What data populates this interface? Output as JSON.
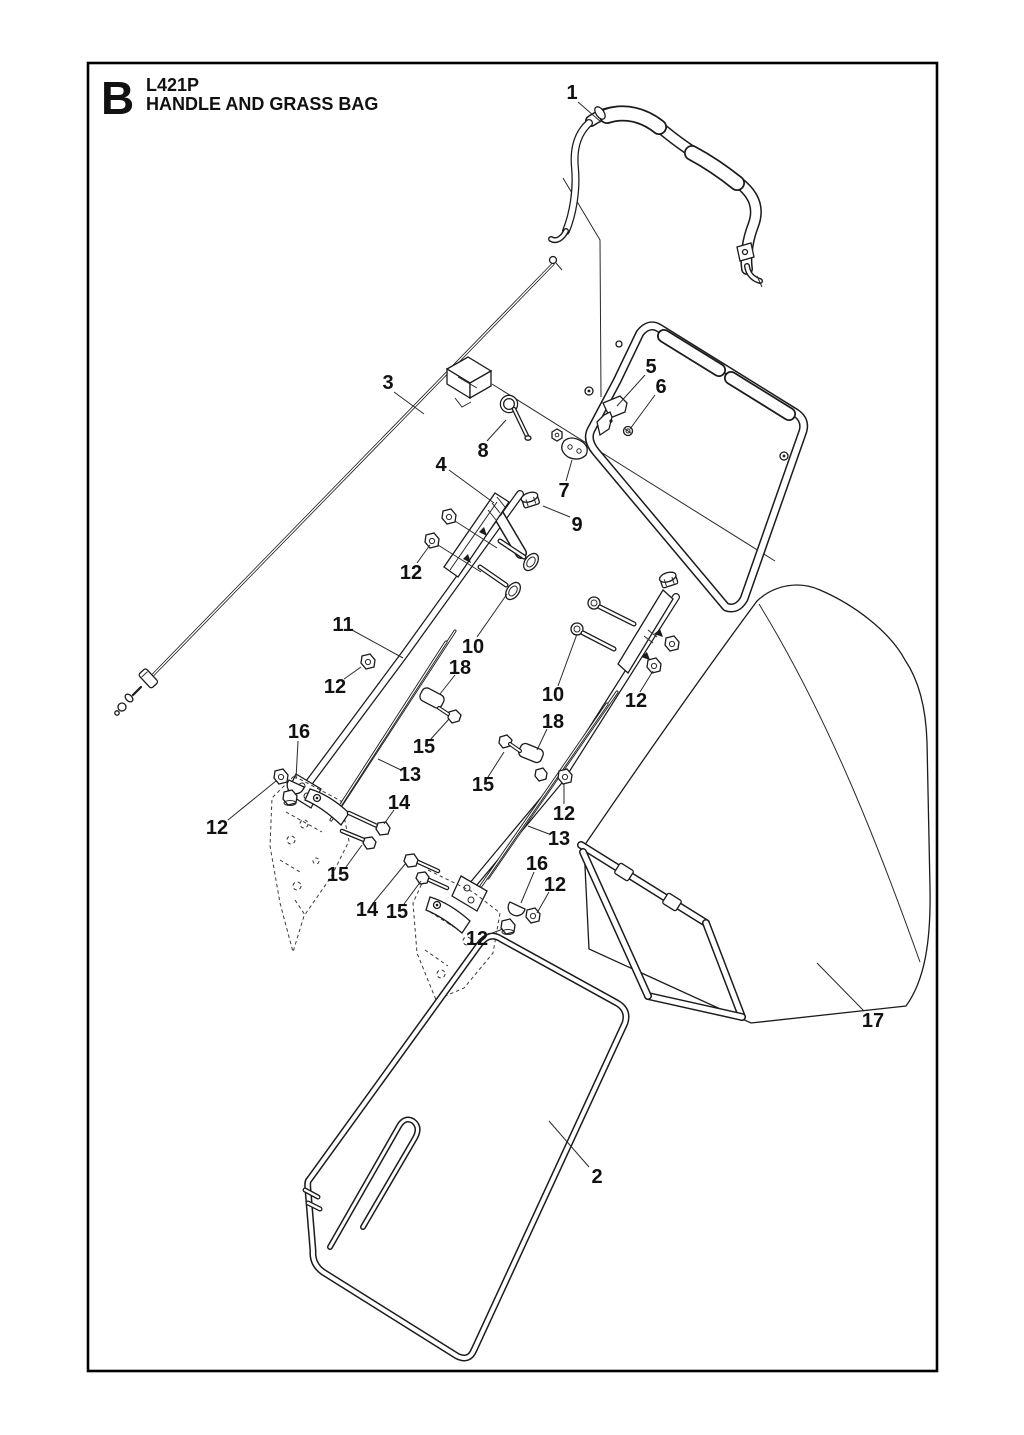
{
  "title_block": {
    "section_letter": "B",
    "model": "L421P",
    "subtitle": "HANDLE AND GRASS BAG"
  },
  "colors": {
    "line": "#1b1b1b",
    "background": "#ffffff"
  },
  "diagram": {
    "description": "Exploded parts view of lawn mower handle and grass bag assembly",
    "part_numbers_visible": [
      1,
      2,
      3,
      4,
      5,
      6,
      7,
      8,
      9,
      10,
      11,
      12,
      13,
      14,
      15,
      16,
      17,
      18
    ],
    "callouts": [
      {
        "label": "1",
        "x": 572,
        "y": 92,
        "leader": [
          578,
          102,
          601,
          122
        ]
      },
      {
        "label": "3",
        "x": 388,
        "y": 382,
        "leader": [
          394,
          392,
          424,
          414
        ]
      },
      {
        "label": "5",
        "x": 651,
        "y": 366,
        "leader": [
          645,
          375,
          617,
          406
        ]
      },
      {
        "label": "6",
        "x": 661,
        "y": 386,
        "leader": [
          655,
          395,
          630,
          429
        ]
      },
      {
        "label": "8",
        "x": 483,
        "y": 450,
        "leader": [
          487,
          441,
          506,
          420
        ]
      },
      {
        "label": "4",
        "x": 441,
        "y": 464,
        "leader": [
          449,
          470,
          494,
          503
        ]
      },
      {
        "label": "7",
        "x": 564,
        "y": 490,
        "leader": [
          566,
          481,
          572,
          460
        ]
      },
      {
        "label": "9",
        "x": 577,
        "y": 524,
        "leader": [
          570,
          517,
          543,
          506
        ]
      },
      {
        "label": "12",
        "x": 411,
        "y": 572,
        "leader": [
          417,
          563,
          430,
          545
        ]
      },
      {
        "label": "11",
        "x": 343,
        "y": 624,
        "leader": [
          352,
          630,
          403,
          658
        ]
      },
      {
        "label": "10",
        "x": 473,
        "y": 646,
        "leader": [
          477,
          637,
          507,
          594
        ]
      },
      {
        "label": "18",
        "x": 460,
        "y": 667,
        "leader": [
          455,
          675,
          440,
          694
        ]
      },
      {
        "label": "12",
        "x": 335,
        "y": 686,
        "leader": [
          344,
          679,
          361,
          667
        ]
      },
      {
        "label": "10",
        "x": 553,
        "y": 694,
        "leader": [
          558,
          686,
          577,
          634
        ]
      },
      {
        "label": "12",
        "x": 636,
        "y": 700,
        "leader": [
          640,
          692,
          653,
          671
        ]
      },
      {
        "label": "18",
        "x": 553,
        "y": 721,
        "leader": [
          547,
          729,
          537,
          750
        ]
      },
      {
        "label": "16",
        "x": 299,
        "y": 731,
        "leader": [
          298,
          741,
          296,
          779
        ]
      },
      {
        "label": "15",
        "x": 424,
        "y": 746,
        "leader": [
          430,
          740,
          449,
          719
        ]
      },
      {
        "label": "13",
        "x": 410,
        "y": 774,
        "leader": [
          401,
          770,
          378,
          759
        ]
      },
      {
        "label": "15",
        "x": 483,
        "y": 784,
        "leader": [
          488,
          777,
          504,
          752
        ]
      },
      {
        "label": "14",
        "x": 399,
        "y": 802,
        "leader": [
          394,
          810,
          384,
          824
        ]
      },
      {
        "label": "12",
        "x": 564,
        "y": 813,
        "leader": [
          564,
          804,
          564,
          784
        ]
      },
      {
        "label": "12",
        "x": 217,
        "y": 827,
        "leader": [
          228,
          820,
          276,
          781
        ]
      },
      {
        "label": "13",
        "x": 559,
        "y": 838,
        "leader": [
          549,
          834,
          528,
          826
        ]
      },
      {
        "label": "16",
        "x": 537,
        "y": 863,
        "leader": [
          534,
          872,
          521,
          903
        ]
      },
      {
        "label": "15",
        "x": 338,
        "y": 874,
        "leader": [
          346,
          867,
          362,
          845
        ]
      },
      {
        "label": "12",
        "x": 555,
        "y": 884,
        "leader": [
          549,
          892,
          537,
          913
        ]
      },
      {
        "label": "14",
        "x": 367,
        "y": 909,
        "leader": [
          374,
          902,
          406,
          863
        ]
      },
      {
        "label": "15",
        "x": 397,
        "y": 911,
        "leader": [
          404,
          904,
          421,
          881
        ]
      },
      {
        "label": "12",
        "x": 477,
        "y": 938,
        "leader": [
          487,
          935,
          503,
          929
        ]
      },
      {
        "label": "17",
        "x": 873,
        "y": 1020,
        "leader": [
          864,
          1011,
          817,
          963
        ]
      },
      {
        "label": "2",
        "x": 597,
        "y": 1176,
        "leader": [
          589,
          1167,
          549,
          1121
        ]
      }
    ]
  }
}
